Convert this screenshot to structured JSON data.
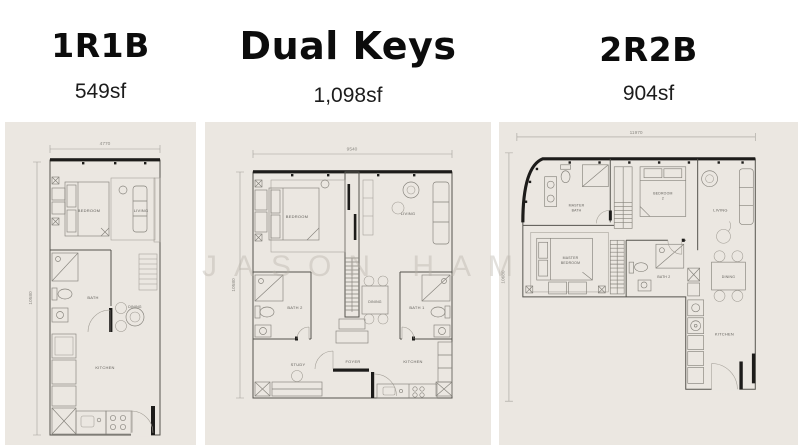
{
  "watermark": "JASON HAM",
  "colors": {
    "panel_bg": "#ebe7e1",
    "line": "#85827b",
    "wall": "#55534d",
    "dark_wall": "#1d1c1a",
    "title_text": "#0c0c0c"
  },
  "units": [
    {
      "title": "1R1B",
      "area": "549sf",
      "dims": {
        "width": "4770",
        "height": "10580"
      },
      "rooms": {
        "bedroom": "BEDROOM",
        "living": "LIVING",
        "bath": "BATH",
        "dining": "DINING",
        "kitchen": "KITCHEN"
      }
    },
    {
      "title": "Dual Keys",
      "area": "1,098sf",
      "dims": {
        "width": "9540",
        "height": "10580"
      },
      "rooms": {
        "bedroom": "BEDROOM",
        "living": "LIVING",
        "bath2": "BATH 2",
        "dining": "DINING",
        "bath1": "BATH 1",
        "study": "STUDY",
        "foyer": "FOYER",
        "kitchen": "KITCHEN"
      }
    },
    {
      "title": "2R2B",
      "area": "904sf",
      "dims": {
        "width": "11970",
        "height": "10680"
      },
      "rooms": {
        "master_bath_1": "MASTER",
        "master_bath_2": "BATH",
        "bedroom2_1": "BEDROOM",
        "bedroom2_2": "2",
        "living": "LIVING",
        "master_bedroom_1": "MASTER",
        "master_bedroom_2": "BEDROOM",
        "bath2": "BATH 2",
        "dining": "DINING",
        "kitchen": "KITCHEN"
      }
    }
  ]
}
